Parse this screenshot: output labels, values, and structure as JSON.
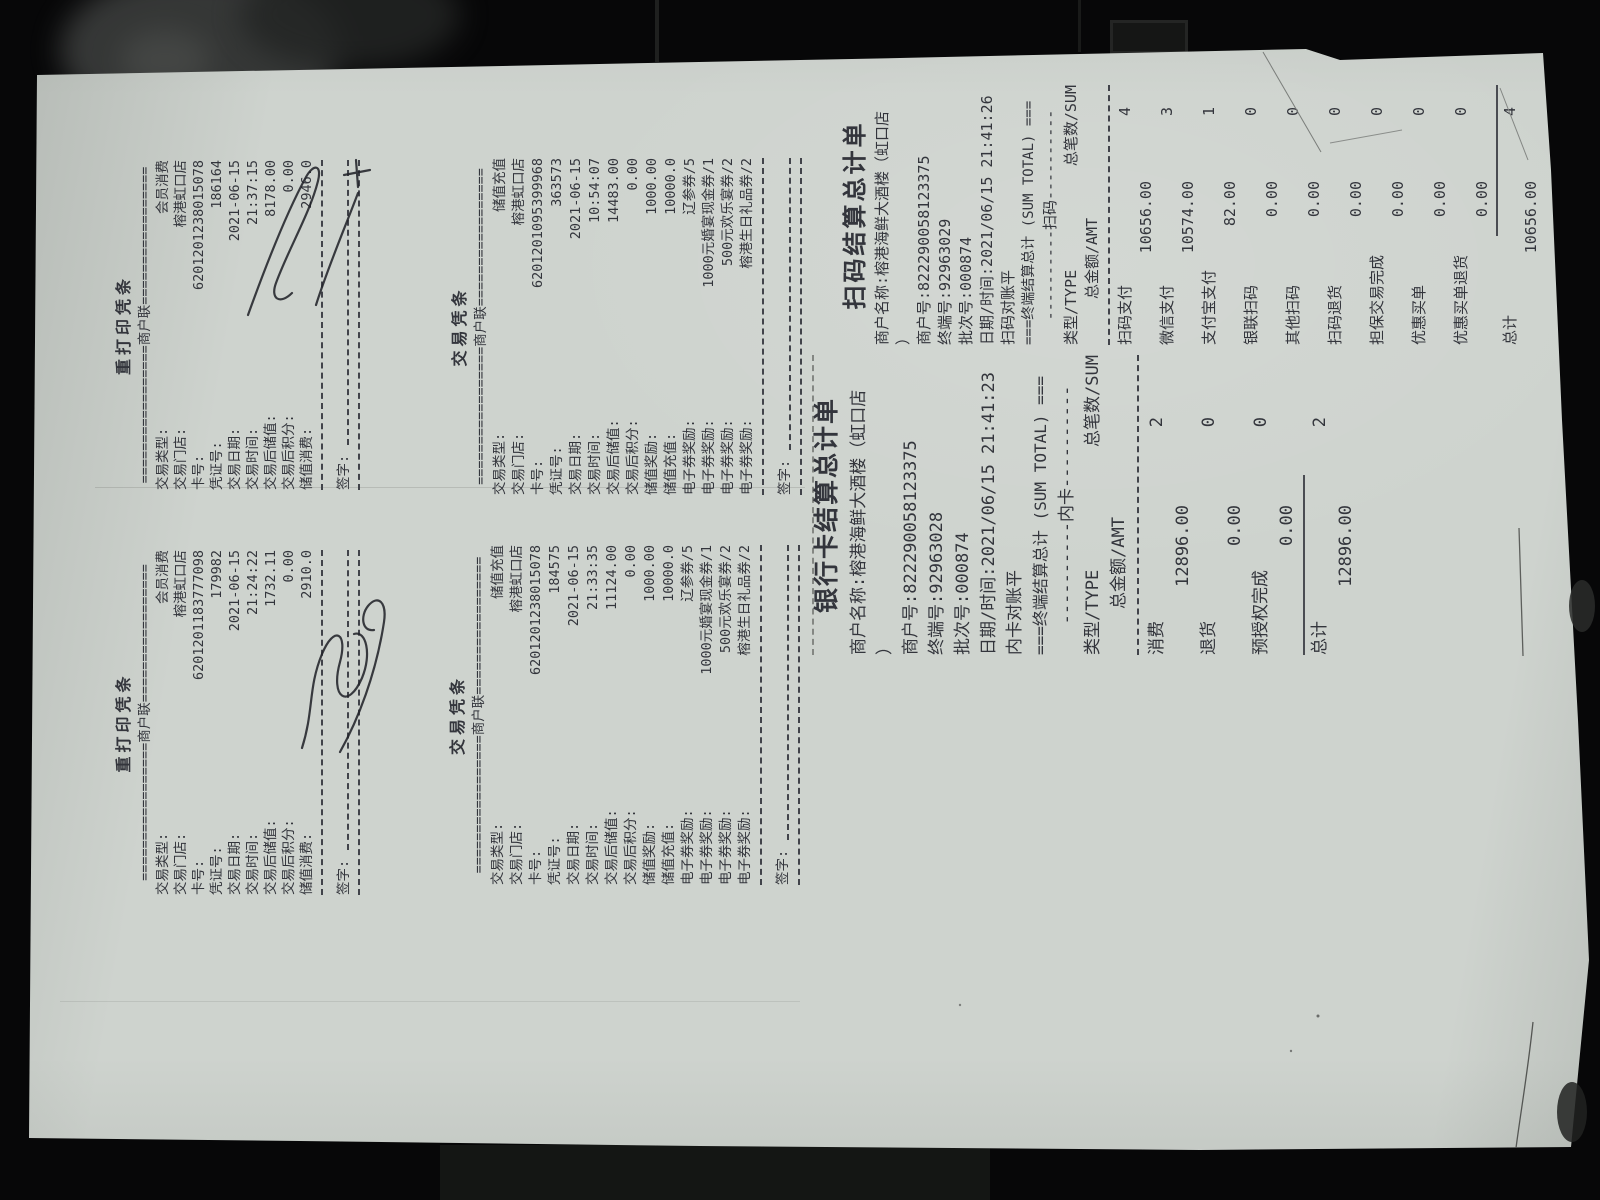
{
  "colors": {
    "background": "#070708",
    "paper": "#ced3ce",
    "ink": "#33353c",
    "signature_ink": "#23242b"
  },
  "receipts": {
    "r1": {
      "title": "重打印凭条",
      "copy": "=================商户联=================",
      "rows": [
        {
          "l": "交易类型:",
          "v": "会员消费"
        },
        {
          "l": "交易门店:",
          "v": "榕港虹口店"
        },
        {
          "l": "卡号:",
          "v": "6201201238015078"
        },
        {
          "l": "凭证号:",
          "v": "186164"
        },
        {
          "l": "交易日期:",
          "v": "2021-06-15"
        },
        {
          "l": "交易时间:",
          "v": "21:37:15"
        },
        {
          "l": "交易后储值:",
          "v": "8178.00"
        },
        {
          "l": "交易后积分:",
          "v": "0.00"
        },
        {
          "l": "储值消费:",
          "v": "2946.0"
        }
      ],
      "sign": "签字:"
    },
    "r2": {
      "title": "重打印凭条",
      "copy": "=================商户联=================",
      "rows": [
        {
          "l": "交易类型:",
          "v": "会员消费"
        },
        {
          "l": "交易门店:",
          "v": "榕港虹口店"
        },
        {
          "l": "卡号:",
          "v": "6201201183777098"
        },
        {
          "l": "凭证号:",
          "v": "179982"
        },
        {
          "l": "交易日期:",
          "v": "2021-06-15"
        },
        {
          "l": "交易时间:",
          "v": "21:24:22"
        },
        {
          "l": "交易后储值:",
          "v": "1732.11"
        },
        {
          "l": "交易后积分:",
          "v": "0.00"
        },
        {
          "l": "储值消费:",
          "v": "2910.0"
        }
      ],
      "sign": "签字:"
    },
    "r3": {
      "title": "交易凭条",
      "copy": "=================商户联=================",
      "rows": [
        {
          "l": "交易类型:",
          "v": "储值充值"
        },
        {
          "l": "交易门店:",
          "v": "榕港虹口店"
        },
        {
          "l": "卡号:",
          "v": "6201201095399968"
        },
        {
          "l": "凭证号:",
          "v": "363573"
        },
        {
          "l": "交易日期:",
          "v": "2021-06-15"
        },
        {
          "l": "交易时间:",
          "v": "10:54:07"
        },
        {
          "l": "交易后储值:",
          "v": "14483.00"
        },
        {
          "l": "交易后积分:",
          "v": "0.00"
        },
        {
          "l": "储值奖励:",
          "v": "1000.00"
        },
        {
          "l": "储值充值:",
          "v": "10000.0"
        },
        {
          "l": "电子券奖励:",
          "v": "辽参券/5"
        },
        {
          "l": "电子券奖励:",
          "v": "1000元婚宴现金券/1"
        },
        {
          "l": "电子券奖励:",
          "v": "500元欢乐宴券/2"
        },
        {
          "l": "电子券奖励:",
          "v": "榕港生日礼品券/2"
        }
      ],
      "sign": "签字:"
    },
    "r4": {
      "title": "交易凭条",
      "copy": "=================商户联=================",
      "rows": [
        {
          "l": "交易类型:",
          "v": "储值充值"
        },
        {
          "l": "交易门店:",
          "v": "榕港虹口店"
        },
        {
          "l": "卡号:",
          "v": "6201201238015078"
        },
        {
          "l": "凭证号:",
          "v": "184575"
        },
        {
          "l": "交易日期:",
          "v": "2021-06-15"
        },
        {
          "l": "交易时间:",
          "v": "21:33:35"
        },
        {
          "l": "交易后储值:",
          "v": "11124.00"
        },
        {
          "l": "交易后积分:",
          "v": "0.00"
        },
        {
          "l": "储值奖励:",
          "v": "1000.00"
        },
        {
          "l": "储值充值:",
          "v": "10000.0"
        },
        {
          "l": "电子券奖励:",
          "v": "辽参券/5"
        },
        {
          "l": "电子券奖励:",
          "v": "1000元婚宴现金券/1"
        },
        {
          "l": "电子券奖励:",
          "v": "500元欢乐宴券/2"
        },
        {
          "l": "电子券奖励:",
          "v": "榕港生日礼品券/2"
        }
      ],
      "sign": "签字:"
    },
    "r5": {
      "title": "扫码结算总计单",
      "info": [
        "商户名称:榕港海鲜大酒楼（虹口店",
        "）",
        "商户号:822290058123375",
        "终端号:92963029",
        "批次号:000874",
        "日期/时间:2021/06/15 21:41:26",
        "扫码对账平"
      ],
      "sum_title": "===终端结算总计 (SUM TOTAL) ===",
      "section": "----------扫码----------",
      "col_type": "类型/TYPE",
      "col_count": "总笔数/SUM",
      "col_amt": "总金额/AMT",
      "entries": [
        {
          "name": "扫码支付",
          "count": "4",
          "amt": "10656.00"
        },
        {
          "name": "微信支付",
          "count": "3",
          "amt": "10574.00"
        },
        {
          "name": "支付宝支付",
          "count": "1",
          "amt": "82.00"
        },
        {
          "name": "银联扫码",
          "count": "0",
          "amt": "0.00"
        },
        {
          "name": "其他扫码",
          "count": "0",
          "amt": "0.00"
        },
        {
          "name": "扫码退货",
          "count": "0",
          "amt": "0.00"
        },
        {
          "name": "担保交易完成",
          "count": "0",
          "amt": "0.00"
        },
        {
          "name": "优惠买单",
          "count": "0",
          "amt": "0.00"
        },
        {
          "name": "优惠买单退货",
          "count": "0",
          "amt": "0.00"
        }
      ],
      "total": {
        "name": "总计",
        "count": "4",
        "amt": "10656.00"
      }
    },
    "r6": {
      "title": "银行卡结算总计单",
      "info": [
        "商户名称:榕港海鲜大酒楼（虹口店",
        "）",
        "商户号:822290058123375",
        "终端号:92963028",
        "批次号:000874",
        "日期/时间:2021/06/15 21:41:23",
        "内卡对账平"
      ],
      "sum_title": "===终端结算总计 (SUM TOTAL) ===",
      "section": "----------内卡----------",
      "col_type": "类型/TYPE",
      "col_count": "总笔数/SUM",
      "col_amt": "总金额/AMT",
      "entries": [
        {
          "name": "消费",
          "count": "2",
          "amt": "12896.00"
        },
        {
          "name": "退货",
          "count": "0",
          "amt": "0.00"
        },
        {
          "name": "预授权完成",
          "count": "0",
          "amt": "0.00"
        }
      ],
      "total": {
        "name": "总计",
        "count": "2",
        "amt": "12896.00"
      }
    }
  }
}
